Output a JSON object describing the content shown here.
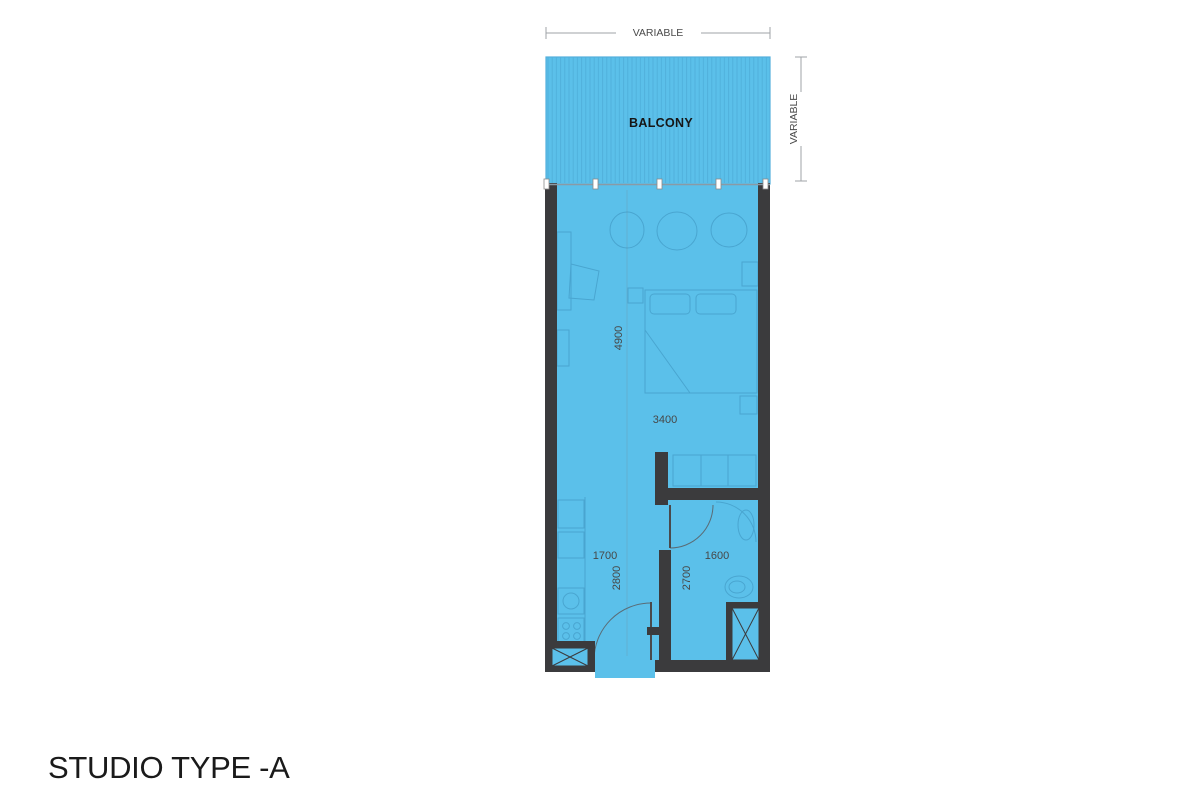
{
  "title": "STUDIO TYPE -A",
  "plan": {
    "balcony_label": "BALCONY",
    "dimensions": {
      "top_width": "VARIABLE",
      "right_depth": "VARIABLE",
      "living_depth": "4900",
      "living_width": "3400",
      "hall_width": "1700",
      "hall_depth": "2800",
      "bath_width": "1600",
      "bath_depth": "2700"
    },
    "colors": {
      "floor": "#5BC0EA",
      "hatch": "#4FAFDA",
      "wall": "#3B3B3D",
      "glass": "#8A9AA5",
      "dimension_line": "#9FA3A7",
      "furniture": "#2D7CA8",
      "dim_text": "#474747",
      "title_text": "#1A1A1A"
    }
  }
}
